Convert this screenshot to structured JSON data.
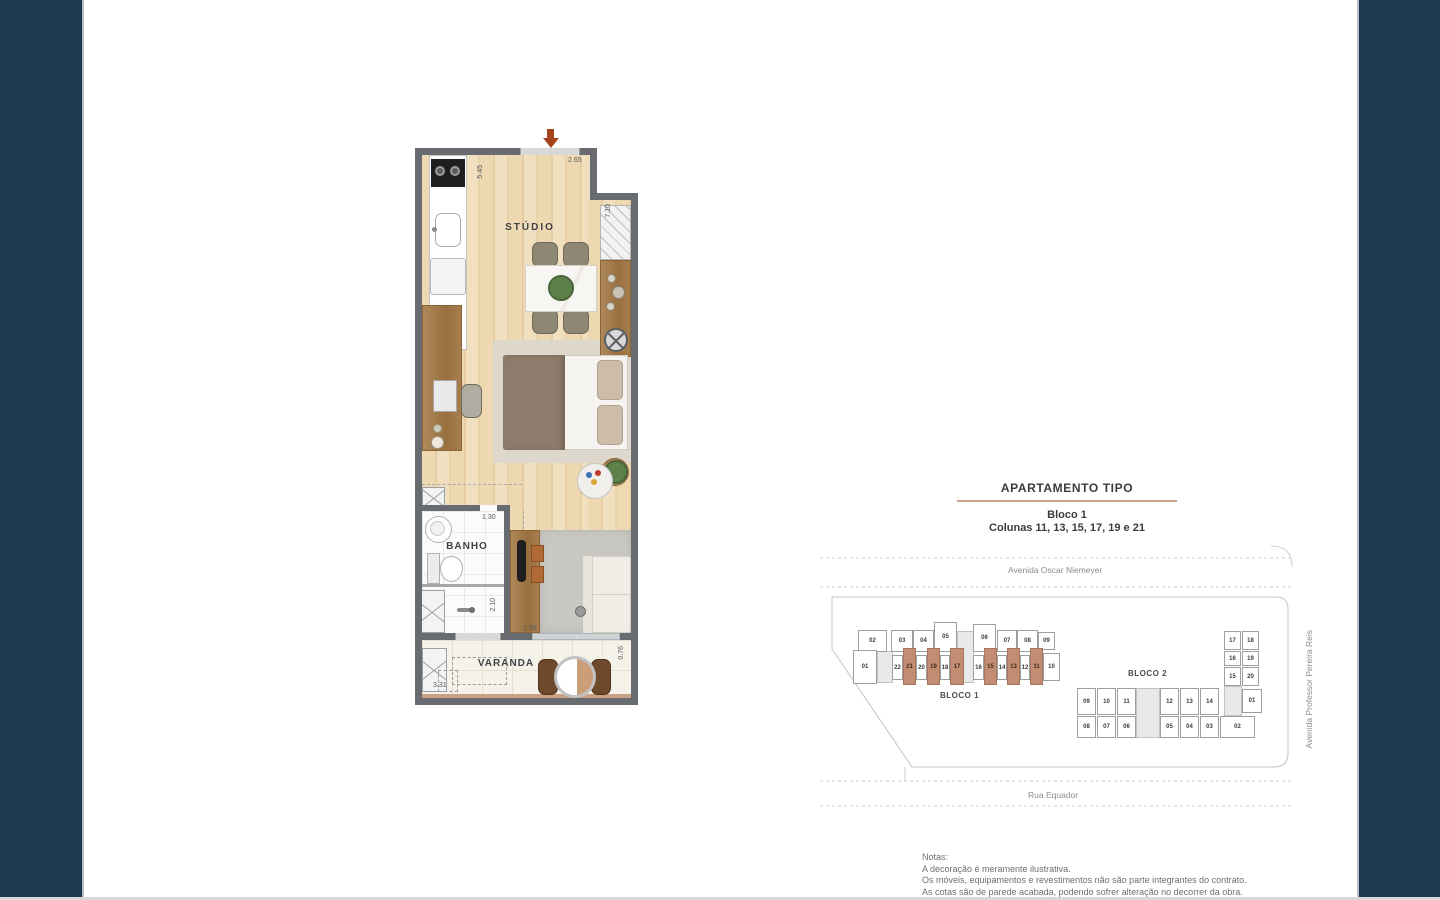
{
  "floorplan": {
    "labels": {
      "studio": "STÚDIO",
      "banho": "BANHO",
      "varanda": "VARANDA"
    },
    "dims": {
      "top": "2.65",
      "left_vertical": "5.45",
      "right_vertical": "7.10",
      "banho": "1.30",
      "shower_vertical": "2.10",
      "corridor": "1.95",
      "varanda_width": "3.31",
      "varanda_depth": "0.76"
    }
  },
  "sidepanel": {
    "title": "APARTAMENTO TIPO",
    "block_line": "Bloco 1",
    "columns_line": "Colunas 11, 13, 15, 17, 19 e 21",
    "street_top": "Avenida Oscar Niemeyer",
    "street_bottom": "Rua Equador",
    "street_right": "Avenida Professor Pereira Reis",
    "bloco1_label": "BLOCO 1",
    "bloco2_label": "BLOCO 2",
    "highlighted_columns": [
      "11",
      "13",
      "15",
      "17",
      "19",
      "21"
    ],
    "bloco1_units": [
      {
        "l": "02",
        "x": 38,
        "y": 85,
        "w": 29,
        "h": 22
      },
      {
        "l": "03",
        "x": 71,
        "y": 85,
        "w": 22,
        "h": 22
      },
      {
        "l": "04",
        "x": 93,
        "y": 85,
        "w": 21,
        "h": 22
      },
      {
        "l": "05",
        "x": 114,
        "y": 77,
        "w": 23,
        "h": 30
      },
      {
        "l": "06",
        "x": 153,
        "y": 79,
        "w": 23,
        "h": 28
      },
      {
        "l": "07",
        "x": 177,
        "y": 85,
        "w": 20,
        "h": 22
      },
      {
        "l": "08",
        "x": 197,
        "y": 85,
        "w": 21,
        "h": 22
      },
      {
        "l": "09",
        "x": 218,
        "y": 87,
        "w": 17,
        "h": 18
      },
      {
        "l": "01",
        "x": 33,
        "y": 105,
        "w": 24,
        "h": 34
      },
      {
        "l": "22",
        "x": 72,
        "y": 110,
        "w": 11,
        "h": 25
      },
      {
        "l": "21",
        "x": 83,
        "y": 103,
        "w": 13,
        "h": 37,
        "hl": true
      },
      {
        "l": "20",
        "x": 96,
        "y": 110,
        "w": 11,
        "h": 25
      },
      {
        "l": "19",
        "x": 107,
        "y": 103,
        "w": 13,
        "h": 37,
        "hl": true
      },
      {
        "l": "18",
        "x": 120,
        "y": 110,
        "w": 10,
        "h": 25
      },
      {
        "l": "17",
        "x": 130,
        "y": 103,
        "w": 14,
        "h": 37,
        "hl": true
      },
      {
        "l": "16",
        "x": 153,
        "y": 110,
        "w": 11,
        "h": 25
      },
      {
        "l": "15",
        "x": 164,
        "y": 103,
        "w": 13,
        "h": 37,
        "hl": true
      },
      {
        "l": "14",
        "x": 177,
        "y": 110,
        "w": 10,
        "h": 25
      },
      {
        "l": "13",
        "x": 187,
        "y": 103,
        "w": 13,
        "h": 37,
        "hl": true
      },
      {
        "l": "12",
        "x": 200,
        "y": 110,
        "w": 10,
        "h": 25
      },
      {
        "l": "11",
        "x": 210,
        "y": 103,
        "w": 13,
        "h": 37,
        "hl": true
      },
      {
        "l": "10",
        "x": 223,
        "y": 108,
        "w": 17,
        "h": 28
      }
    ],
    "bloco2_units": [
      {
        "l": "17",
        "x": 404,
        "y": 86,
        "w": 17,
        "h": 19
      },
      {
        "l": "18",
        "x": 422,
        "y": 86,
        "w": 17,
        "h": 19
      },
      {
        "l": "16",
        "x": 404,
        "y": 106,
        "w": 17,
        "h": 15
      },
      {
        "l": "19",
        "x": 422,
        "y": 106,
        "w": 17,
        "h": 15
      },
      {
        "l": "15",
        "x": 404,
        "y": 122,
        "w": 17,
        "h": 19
      },
      {
        "l": "20",
        "x": 422,
        "y": 122,
        "w": 17,
        "h": 19
      },
      {
        "l": "01",
        "x": 422,
        "y": 144,
        "w": 20,
        "h": 24
      },
      {
        "l": "09",
        "x": 257,
        "y": 143,
        "w": 19,
        "h": 27
      },
      {
        "l": "10",
        "x": 277,
        "y": 143,
        "w": 19,
        "h": 27
      },
      {
        "l": "11",
        "x": 297,
        "y": 143,
        "w": 19,
        "h": 27
      },
      {
        "l": "12",
        "x": 340,
        "y": 143,
        "w": 19,
        "h": 27
      },
      {
        "l": "13",
        "x": 360,
        "y": 143,
        "w": 19,
        "h": 27
      },
      {
        "l": "14",
        "x": 380,
        "y": 143,
        "w": 19,
        "h": 27
      },
      {
        "l": "08",
        "x": 257,
        "y": 171,
        "w": 19,
        "h": 22
      },
      {
        "l": "07",
        "x": 277,
        "y": 171,
        "w": 19,
        "h": 22
      },
      {
        "l": "06",
        "x": 297,
        "y": 171,
        "w": 19,
        "h": 22
      },
      {
        "l": "05",
        "x": 340,
        "y": 171,
        "w": 19,
        "h": 22
      },
      {
        "l": "04",
        "x": 360,
        "y": 171,
        "w": 19,
        "h": 22
      },
      {
        "l": "03",
        "x": 380,
        "y": 171,
        "w": 19,
        "h": 22
      },
      {
        "l": "02",
        "x": 400,
        "y": 171,
        "w": 35,
        "h": 22
      }
    ],
    "connectors": [
      {
        "x": 57,
        "y": 106,
        "w": 16,
        "h": 32
      },
      {
        "x": 137,
        "y": 86,
        "w": 17,
        "h": 52
      },
      {
        "x": 316,
        "y": 143,
        "w": 24,
        "h": 50
      },
      {
        "x": 404,
        "y": 141,
        "w": 18,
        "h": 30
      }
    ],
    "notes_title": "Notas:",
    "notes": [
      "A decoração é meramente ilustrativa.",
      "Os móveis, equipamentos e revestimentos não são parte integrantes do contrato.",
      "As cotas são de parede acabada, podendo sofrer alteração no decorrer da obra."
    ]
  },
  "colors": {
    "frame": "#1d3850",
    "title_rule": "#cf9f8b",
    "unit_highlight": "#c28d72",
    "wall": "#686c70",
    "wood_floor": "#eed8b1",
    "entry_arrow": "#a7431d"
  }
}
